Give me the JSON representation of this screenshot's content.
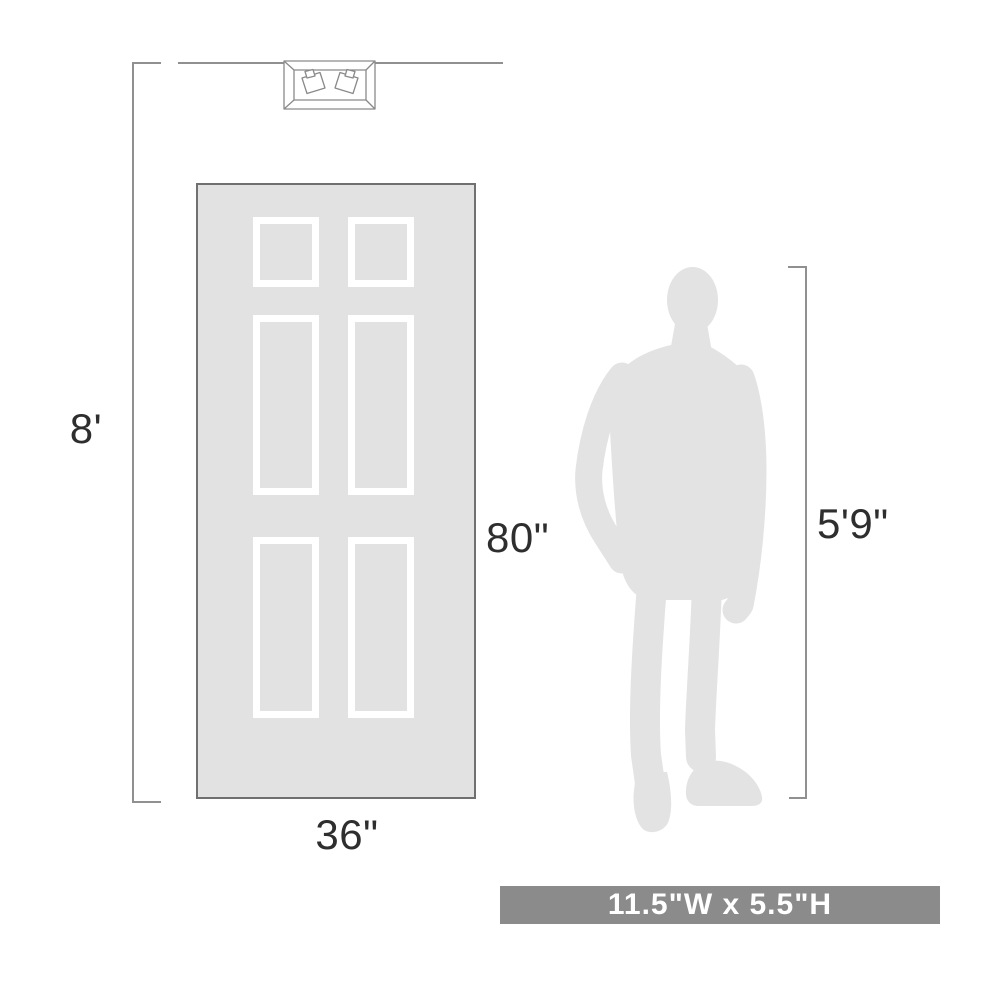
{
  "diagram": {
    "title_semantic": "product-scale-dimension-diagram",
    "labels": {
      "ceiling_height": "8'",
      "door_height": "80\"",
      "door_width": "36\"",
      "person_height": "5'9\"",
      "fixture_size": "11.5\"W x 5.5\"H"
    },
    "colors": {
      "background": "#ffffff",
      "silhouette_fill": "#e3e3e3",
      "door_fill": "#e2e2e2",
      "door_border": "#707070",
      "panel_frame": "#ffffff",
      "dimension_line": "#909090",
      "fixture_line": "#8a8a8a",
      "label_text": "#2e2e2e",
      "banner_background": "#8b8b8b",
      "banner_text": "#ffffff"
    },
    "icons": {
      "ceiling_fixture": "two-light-flush-mount-fixture-drawing",
      "person": "standing-man-silhouette"
    }
  }
}
